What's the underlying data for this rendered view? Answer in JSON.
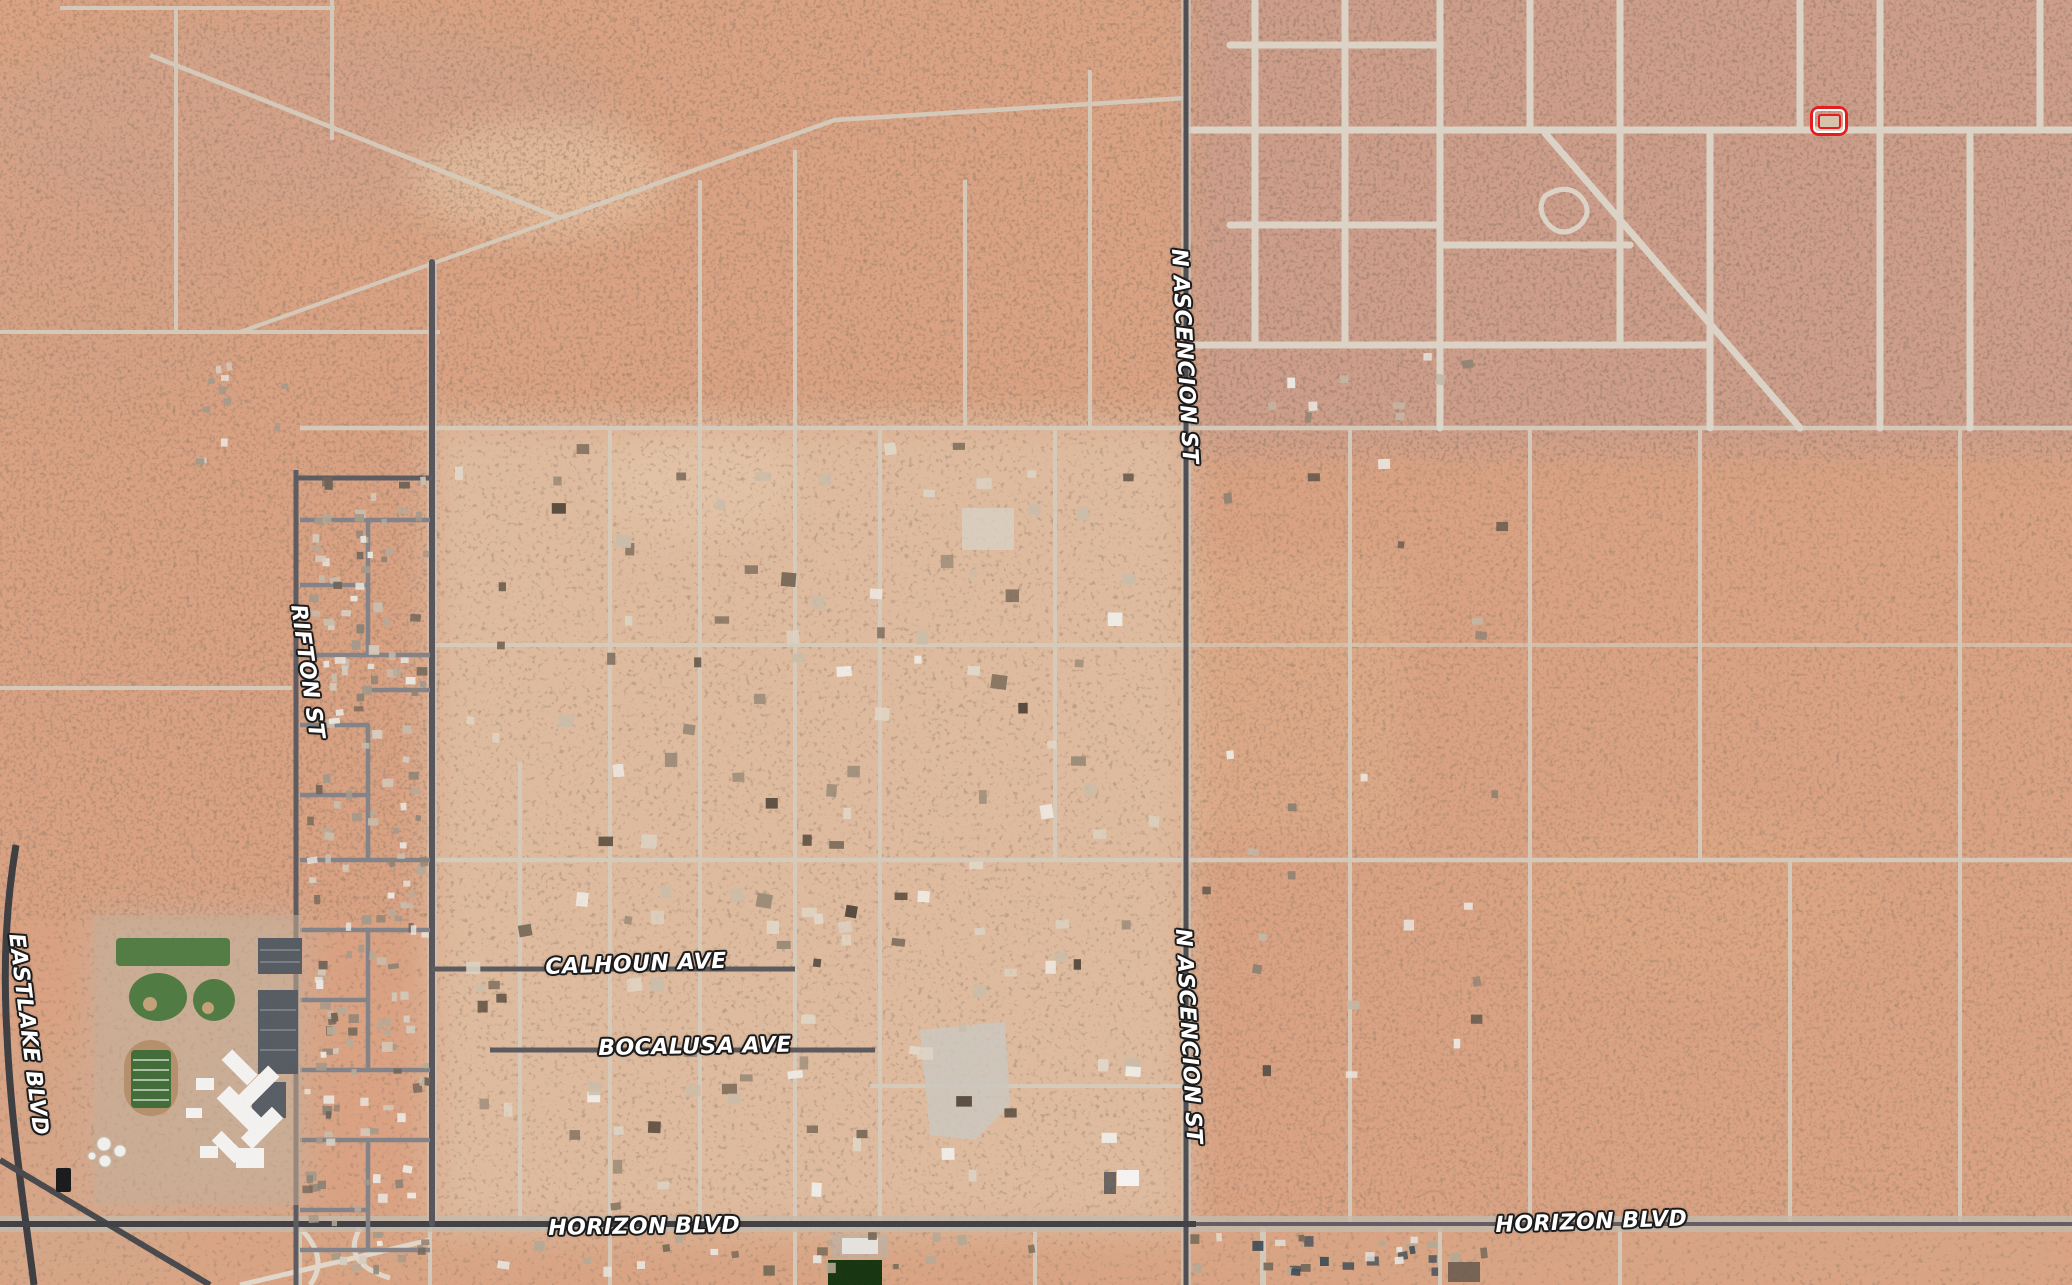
{
  "map": {
    "view": "satellite",
    "street_labels": [
      {
        "id": "eastlake-blvd",
        "text": "EASTLAKE BLVD"
      },
      {
        "id": "rifton-st",
        "text": "RIFTON ST"
      },
      {
        "id": "n-ascencion-st-north",
        "text": "N ASCENCION ST"
      },
      {
        "id": "n-ascencion-st-south",
        "text": "N ASCENCION ST"
      },
      {
        "id": "calhoun-ave",
        "text": "CALHOUN AVE"
      },
      {
        "id": "bocalusa-ave",
        "text": "BOCALUSA AVE"
      },
      {
        "id": "horizon-blvd-west",
        "text": "HORIZON BLVD"
      },
      {
        "id": "horizon-blvd-east",
        "text": "HORIZON BLVD"
      }
    ],
    "marker": {
      "type": "parcel-outline",
      "color": "#e41e1e"
    },
    "colors": {
      "desert_base": "#dca383",
      "settlement": "#e0c9ad",
      "road_paved": "#4a494e",
      "road_dirt": "#d6cdbe",
      "field_green": "#4e7a41"
    }
  }
}
